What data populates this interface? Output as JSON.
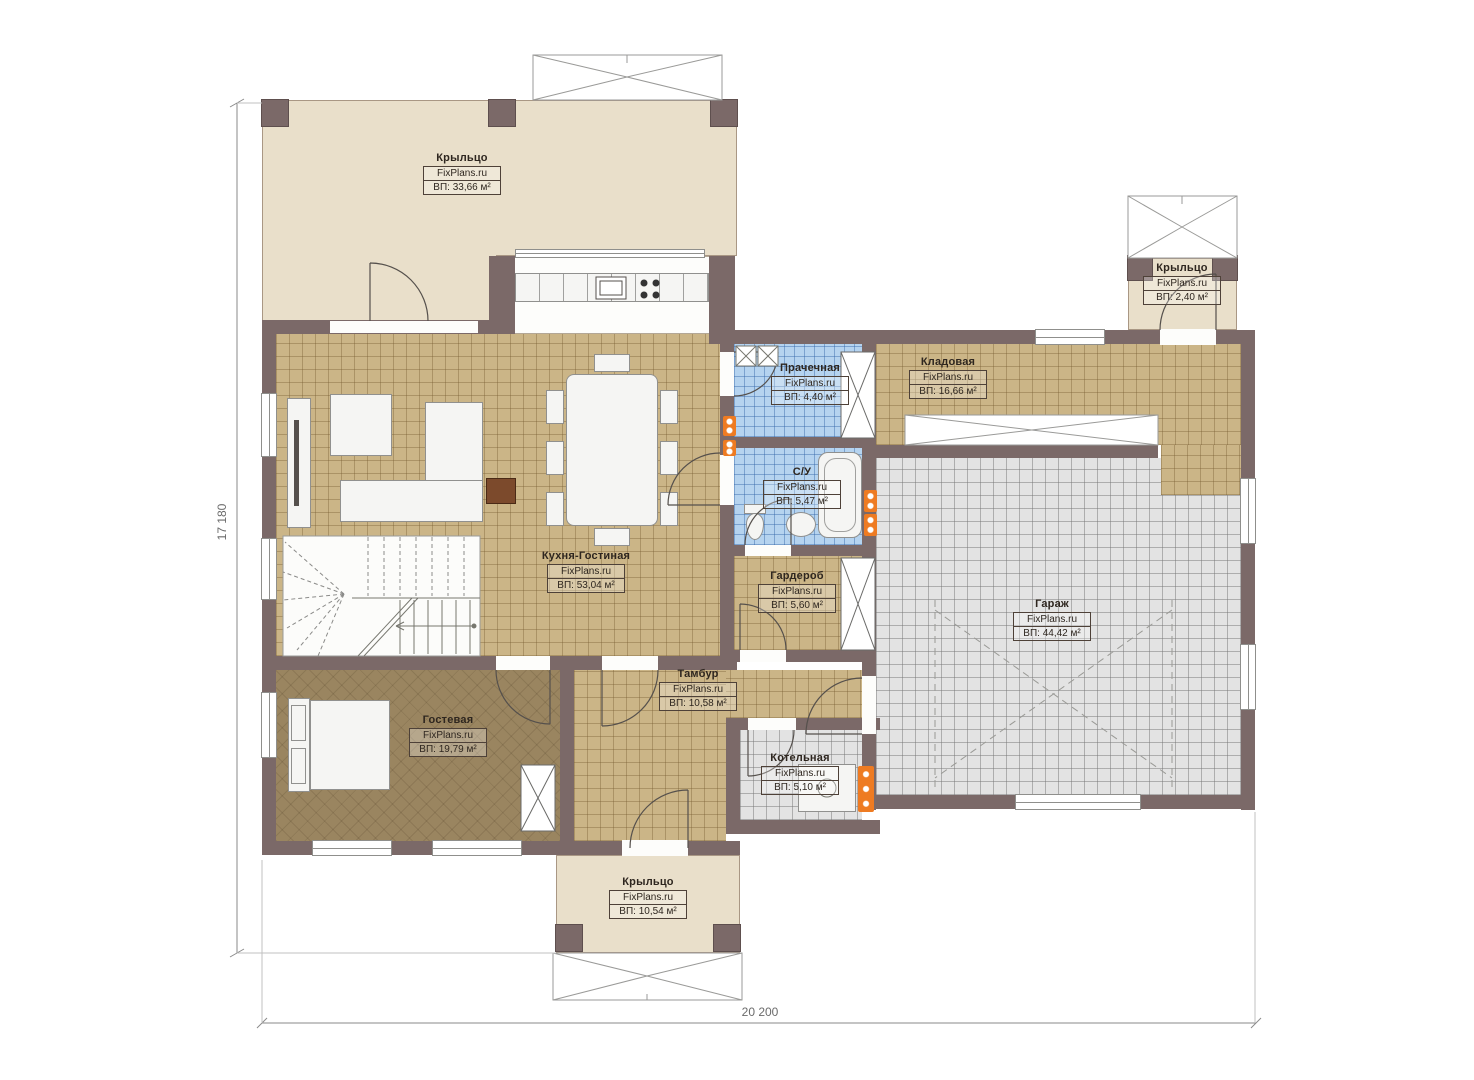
{
  "watermark": "FixPlans.ru",
  "rooms": [
    {
      "name": "Крыльцо",
      "area": "ВП: 33,66 м²"
    },
    {
      "name": "Крыльцо",
      "area": "ВП: 2,40 м²"
    },
    {
      "name": "Прачечная",
      "area": "ВП: 4,40 м²"
    },
    {
      "name": "Кладовая",
      "area": "ВП: 16,66 м²"
    },
    {
      "name": "С/У",
      "area": "ВП: 5,47 м²"
    },
    {
      "name": "Кухня-Гостиная",
      "area": "ВП: 53,04 м²"
    },
    {
      "name": "Гардероб",
      "area": "ВП: 5,60 м²"
    },
    {
      "name": "Гараж",
      "area": "ВП: 44,42 м²"
    },
    {
      "name": "Тамбур",
      "area": "ВП: 10,58 м²"
    },
    {
      "name": "Котельная",
      "area": "ВП: 5,10 м²"
    },
    {
      "name": "Гостевая",
      "area": "ВП: 19,79 м²"
    },
    {
      "name": "Крыльцо",
      "area": "ВП: 10,54 м²"
    }
  ],
  "dimensions": {
    "height_label": "17 180",
    "width_label": "20 200"
  },
  "palette": {
    "wall": "#7b6968",
    "porch": "#e9dfca",
    "tile_tan": "#cbb587",
    "tile_blue": "#b5d3ef",
    "tile_gray": "#e3e3e3",
    "floor_brown": "#9a8560",
    "radiator": "#ee7b22"
  }
}
